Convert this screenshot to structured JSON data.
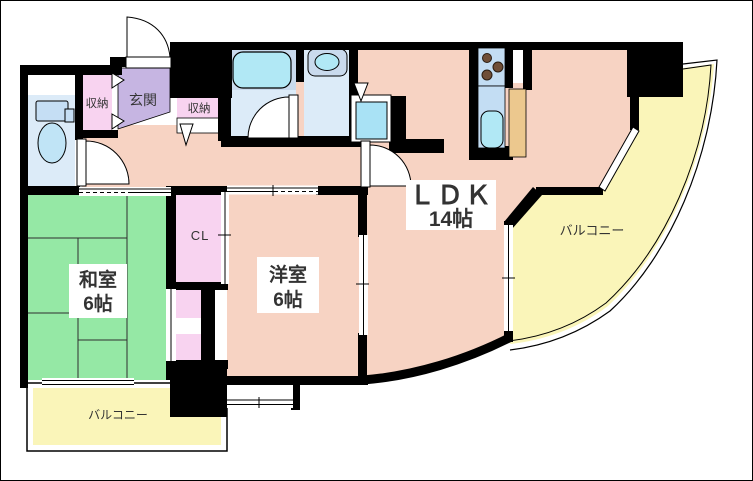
{
  "page": {
    "title": "間取り図"
  },
  "labels": {
    "ldk": "ＬＤＫ",
    "ldk_size": "14帖",
    "washitsu": "和室",
    "washitsu_size": "6帖",
    "youshitsu": "洋室",
    "youshitsu_size": "6帖",
    "genkan": "玄関",
    "closet": "CL",
    "storage1": "収納",
    "storage2": "収納",
    "balcony_right": "バルコニー",
    "balcony_bottom": "バルコニー"
  },
  "colors": {
    "wall": "#000000",
    "room": "#F7D3C3",
    "tatami": "#95E8A5",
    "entrance": "#C6B5E2",
    "closet": "#F8D3F0",
    "balcony": "#FAF5B9",
    "bath_floor": "#DCEBF8",
    "bath_zone": "#C9DAED",
    "fixture_water": "#B1E8F5",
    "appliance": "#A9E2F5",
    "kitchen_counter": "#C3DDF3",
    "counter_top": "#ECC88E",
    "burner": "#6F4E37"
  }
}
